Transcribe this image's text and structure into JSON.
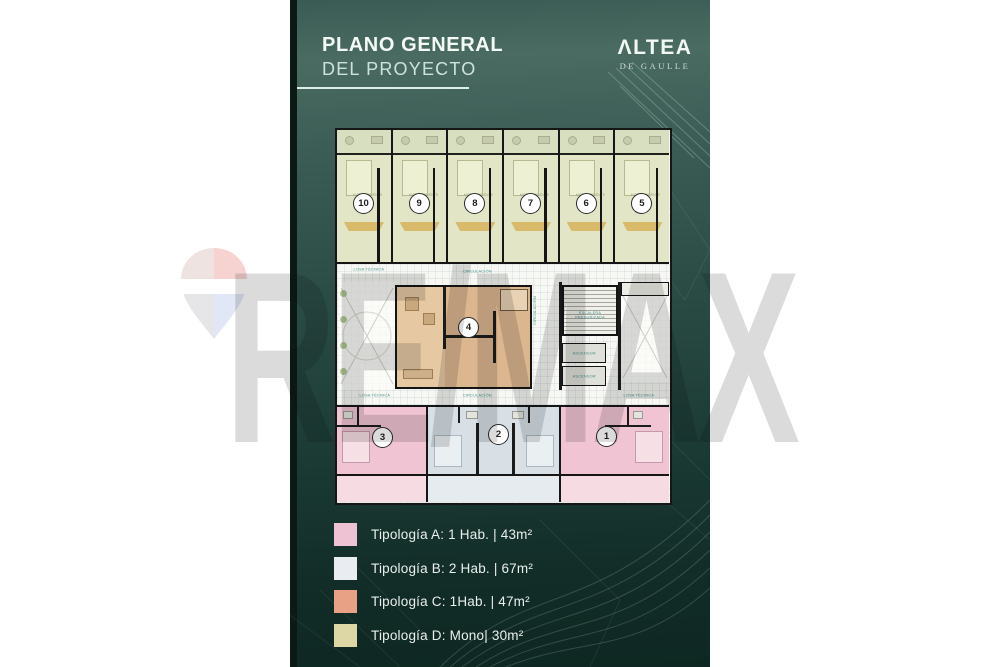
{
  "header": {
    "title_line1": "PLANO GENERAL",
    "title_line2": "DEL PROYECTO"
  },
  "brand": {
    "name": "ΛLTEA",
    "subtitle": "DE GAULLE"
  },
  "watermark": {
    "text": "RE/MAX",
    "balloon_icon": "remax-balloon"
  },
  "plan": {
    "labels": {
      "mono": "MONOAMBIENTE",
      "circulacion": "CIRCULACIÓN",
      "losa_tecnica": "LOSA TÉCNICA",
      "escalera_line1": "ESCALERA",
      "escalera_line2": "PRESURIZADA",
      "ascensor": "ASCENSOR"
    },
    "top_units": [
      {
        "number": "10",
        "type": "D"
      },
      {
        "number": "9",
        "type": "D"
      },
      {
        "number": "8",
        "type": "D"
      },
      {
        "number": "7",
        "type": "D"
      },
      {
        "number": "6",
        "type": "D"
      },
      {
        "number": "5",
        "type": "D"
      }
    ],
    "middle_unit": {
      "number": "4",
      "type": "C"
    },
    "bottom_units": [
      {
        "number": "3",
        "type": "A"
      },
      {
        "number": "2",
        "type": "B"
      },
      {
        "number": "1",
        "type": "A"
      }
    ]
  },
  "legend": {
    "items": [
      {
        "label": "Tipología A: 1 Hab. | 43m²",
        "color": "#eec2d3"
      },
      {
        "label": "Tipología B: 2 Hab. | 67m²",
        "color": "#e9edf1"
      },
      {
        "label": "Tipología C: 1Hab. | 47m²",
        "color": "#e8a184"
      },
      {
        "label": "Tipología D: Mono| 30m²",
        "color": "#ddd7a5"
      }
    ]
  },
  "colors": {
    "panel_teal_top": "#4a6b62",
    "panel_teal_bottom": "#0e2722",
    "type_a_pink": "#f0c4d2",
    "type_b_blue": "#d8e0e6",
    "type_c_tan": "#dcb68f",
    "type_d_green": "#e2e6c6",
    "label_teal": "#3f8f85",
    "watermark_gray": "#d7d7d7"
  }
}
